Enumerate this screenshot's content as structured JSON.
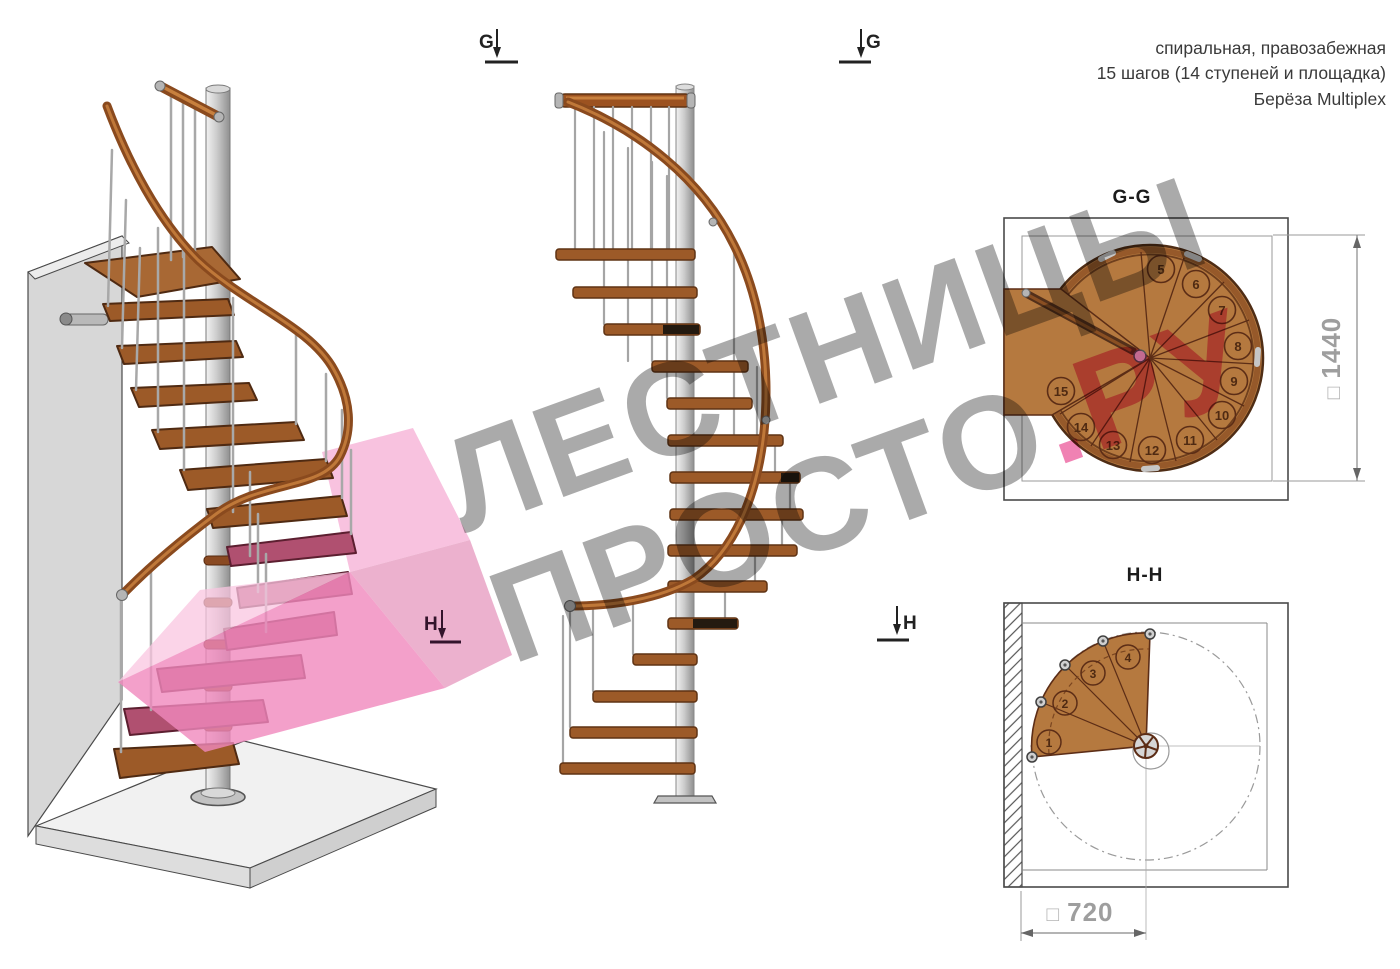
{
  "header": {
    "line1": "спиральная, правозабежная",
    "line2": "15 шагов (14 ступеней и площадка)",
    "line3": "Берёза Multiplex"
  },
  "markers": {
    "g_left": "G",
    "g_right": "G",
    "h_left": "H",
    "h_right": "H"
  },
  "plan_gg": {
    "title": "G-G",
    "dim_square": "□",
    "dim_value": "1440",
    "steps": [
      "5",
      "6",
      "7",
      "8",
      "9",
      "10",
      "11",
      "12",
      "13",
      "14",
      "15"
    ]
  },
  "plan_hh": {
    "title": "H-H",
    "dim_square": "□",
    "dim_value": "720",
    "steps": [
      "1",
      "2",
      "3",
      "4"
    ]
  },
  "watermark": {
    "line1": "ЛЕСТНИЦЫ",
    "line2_gray": "ПРОСТО",
    "line2_accent": ".РУ"
  },
  "colors": {
    "wood": "#b5793f",
    "wood_dark": "#4f2a12",
    "tread": "#9c5a28",
    "tread_pink": "#b05070",
    "rail": "#8a4a1e",
    "steel": "#c4c4c4",
    "pink_plane": "#f088bd",
    "dim_text": "#9e9e9e",
    "watermark_gray": "#767676",
    "watermark_accent": "#ec5f9e"
  }
}
